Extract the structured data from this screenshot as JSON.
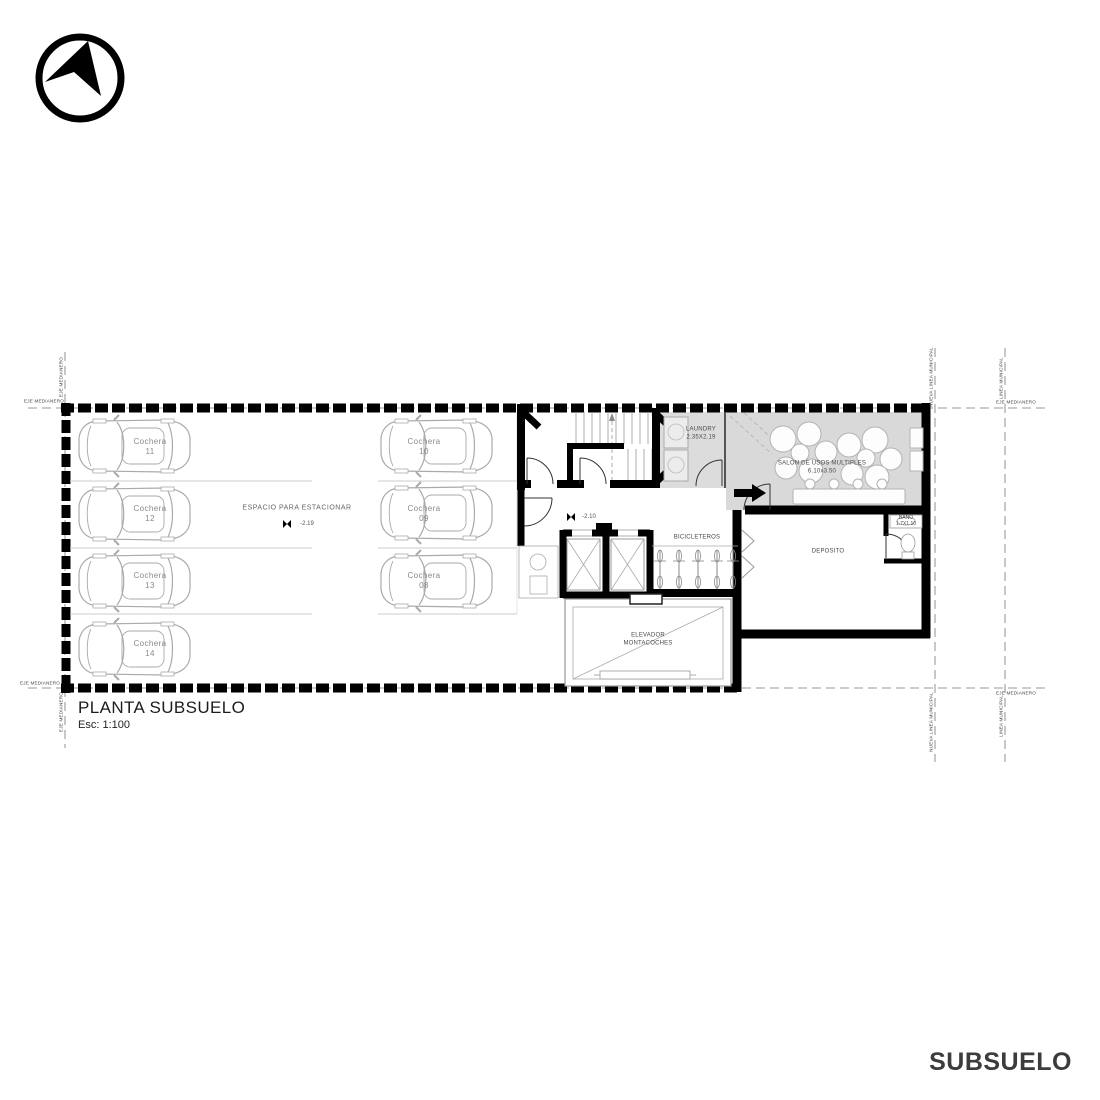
{
  "title": {
    "main": "PLANTA SUBSUELO",
    "scale": "Esc: 1:100"
  },
  "footer_label": "SUBSUELO",
  "parking": {
    "area_label": "ESPACIO PARA ESTACIONAR",
    "area_level": "-2.19",
    "stalls_left": [
      {
        "label": "Cochera",
        "number": "11"
      },
      {
        "label": "Cochera",
        "number": "12"
      },
      {
        "label": "Cochera",
        "number": "13"
      },
      {
        "label": "Cochera",
        "number": "14"
      }
    ],
    "stalls_right": [
      {
        "label": "Cochera",
        "number": "10"
      },
      {
        "label": "Cochera",
        "number": "09"
      },
      {
        "label": "Cochera",
        "number": "08"
      }
    ]
  },
  "rooms": {
    "laundry": {
      "name": "LAUNDRY",
      "dims": "2.35X2.19"
    },
    "salon": {
      "name": "SALON DE USOS MULTIPLES",
      "dims": "6.10x3.50"
    },
    "bicicleteros": {
      "name": "BICICLETEROS"
    },
    "deposito": {
      "name": "DEPOSITO"
    },
    "bano": {
      "name": "BAÑO",
      "dims": "1.7X1.10"
    },
    "elevador": {
      "line1": "ELEVADOR",
      "line2": "MONTACOCHES"
    },
    "lobby_level": "-2.10"
  },
  "reference_lines": {
    "eje_medianero": "EJE MEDIANERO",
    "nueva_linea_municipal": "NUEVA LINEA MUNICIPAL",
    "linea_municipal": "LINEA MUNICIPAL"
  },
  "icons": {
    "compass": "north-arrow-compass",
    "level_marker": "survey-level-marker"
  },
  "colors": {
    "wall": "#000000",
    "room_fill": "#d9d9d9",
    "line_gray": "#9a9a9a",
    "text_dark": "#3c3c3c"
  }
}
